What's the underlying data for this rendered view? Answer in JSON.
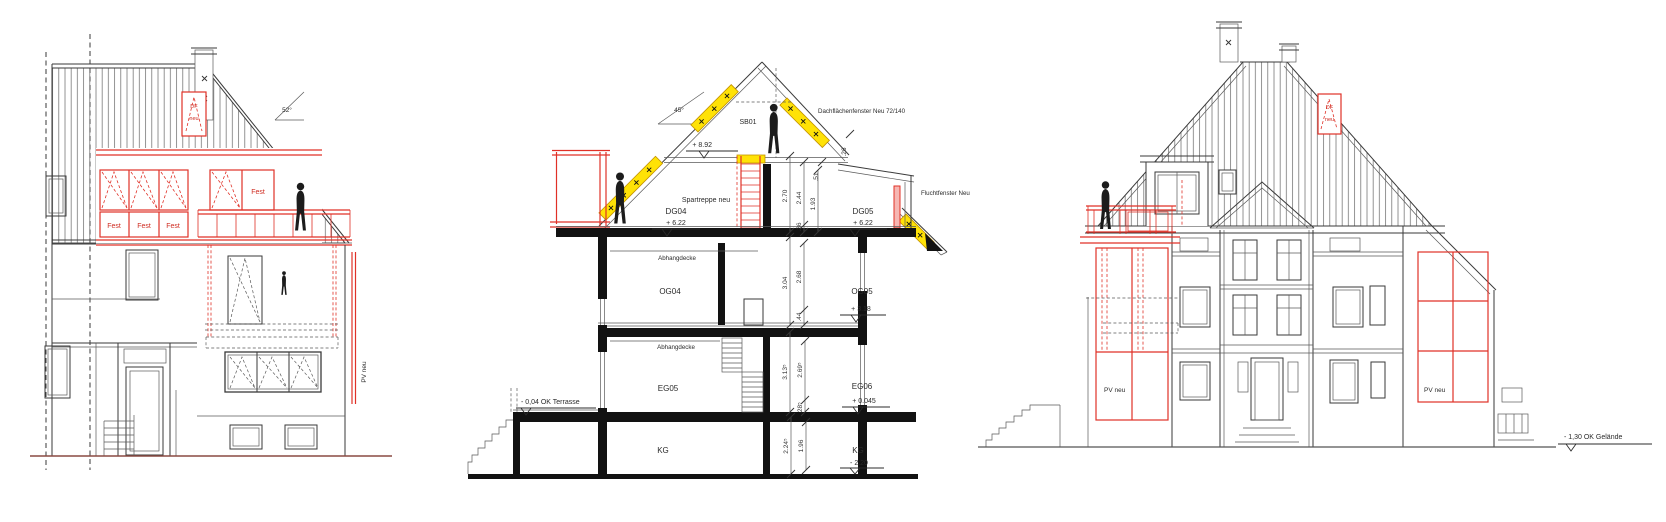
{
  "left_elevation": {
    "angle": "52°",
    "df_marker": {
      "l1": "DF",
      "l2": "neu"
    },
    "fest_1": "Fest",
    "fest_2": "Fest",
    "fest_3": "Fest",
    "fest_4": "Fest",
    "pv_label": "PV neu"
  },
  "section": {
    "angle": "45°",
    "ridge_room": "SB01",
    "roof_window_note": "Dachflächenfenster Neu 72/140",
    "escape_window_note": "Fluchtfenster Neu",
    "stair_note": "Spartreppe neu",
    "level_ridge": "+ 8.92",
    "terrace_note": "- 0,04 OK Terrasse",
    "ceiling_og": "Abhangdecke",
    "ceiling_eg": "Abhangdecke",
    "rooms": {
      "dg04": "DG04",
      "dg04_level": "+ 6.22",
      "dg05": "DG05",
      "dg05_level": "+ 6.22",
      "og04": "OG04",
      "og05": "OG05",
      "og05_level": "+ 3.18",
      "eg05": "EG05",
      "eg06": "EG06",
      "eg06_level": "+ 0.045",
      "kg_left": "KG",
      "kg_right": "KG",
      "kg_level": "- 2.20"
    },
    "dims": {
      "dg_270": "2.70",
      "dg_244": "2.44",
      "dg_193": "1.93",
      "dg_36": ".36",
      "dg_51": ".51",
      "dg_26": ".26",
      "og_304": "3.04",
      "og_268": "2.68",
      "og_44": ".44",
      "eg_3135": "3.13⁵",
      "eg_2695": "2.69⁵",
      "eg_285": ".28⁵",
      "kg_2245": "2.24⁵",
      "kg_196": "1.96"
    }
  },
  "right_elevation": {
    "df_marker": {
      "l1": "DF",
      "l2": "neu"
    },
    "pv_left": "PV neu",
    "pv_right": "PV neu",
    "ground_note": "- 1,30 OK Gelände"
  },
  "colors": {
    "new_red": "#e03127",
    "highlight_yellow": "#ffe206"
  }
}
